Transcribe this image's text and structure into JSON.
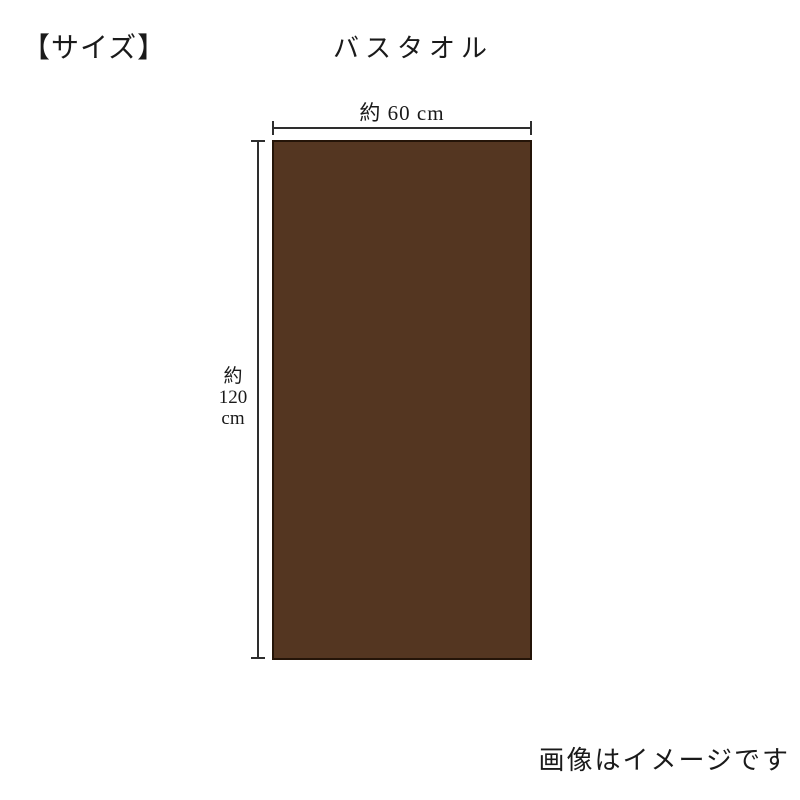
{
  "page": {
    "size_heading": "【サイズ】",
    "product_heading": "バスタオル",
    "note": "画像はイメージです"
  },
  "diagram": {
    "item_name": "バスタオル",
    "width_label": "約 60 cm",
    "width_cm": 60,
    "height_label_lines": [
      "約",
      "120",
      "cm"
    ],
    "height_cm": 120,
    "towel_color": "#543621",
    "towel_border_color": "#241408",
    "dimension_line_color": "#2e2e2e"
  }
}
